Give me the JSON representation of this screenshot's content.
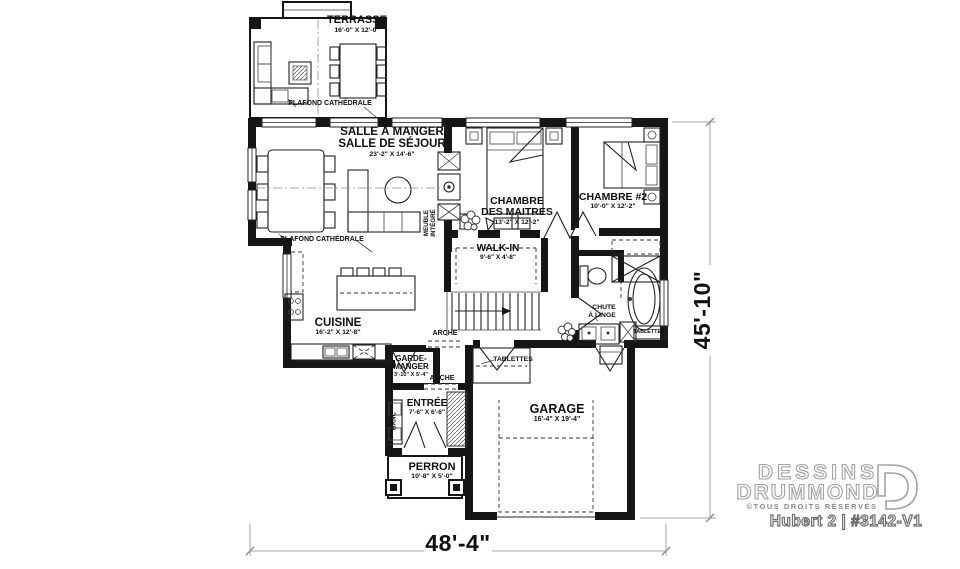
{
  "plan": {
    "rooms": {
      "terrasse": {
        "name": "TERRASSE",
        "dims": "16'-0\" X 12'-0\""
      },
      "salle_a_manger": {
        "line1": "SALLE À MANGER",
        "line2": "SALLE DE SÉJOUR",
        "dims": "23'-2\" X 14'-6\""
      },
      "chambre_maitres": {
        "line1": "CHAMBRE",
        "line2": "DES MAITRES",
        "dims": "13'-2\" X 12'-2\""
      },
      "chambre2": {
        "name": "CHAMBRE #2",
        "dims": "10'-0\" X 12'-2\""
      },
      "walk_in": {
        "name": "WALK-IN",
        "dims": "9'-6\" X 4'-8\""
      },
      "cuisine": {
        "name": "CUISINE",
        "dims": "16'-2\" X 12'-8\""
      },
      "garde_manger": {
        "line1": "GARDE-",
        "line2": "MANGER",
        "dims": "3'-10\" X 5'-4\""
      },
      "entree": {
        "name": "ENTRÉE",
        "dims": "7'-6\" X 6'-6\""
      },
      "perron": {
        "name": "PERRON",
        "dims": "10'-8\" X 5'-0\""
      },
      "garage": {
        "name": "GARAGE",
        "dims": "16'-4\" X 19'-4\""
      }
    },
    "annotations": {
      "plafond_cathedrale_terrasse": "PLAFOND CATHÉDRALE",
      "plafond_cathedrale_sejour": "PLAFOND CATHÉDRALE",
      "meuble_integre_line1": "MEUBLE",
      "meuble_integre_line2": "INTÉGRÉ",
      "arche_hall": "ARCHE",
      "arche_entree": "ARCHE",
      "banc": "BANC",
      "tablettes_garage": "TABLETTES",
      "tablettes_bain": "TABLETTES",
      "chute_line1": "CHUTE",
      "chute_line2": "À LINGE"
    },
    "dimensions": {
      "width": "48'-4\"",
      "height": "45'-10\""
    }
  },
  "branding": {
    "logo_line1": "DESSINS",
    "logo_line2": "DRUMMOND",
    "rights": "©TOUS DROITS RÉSERVÉS",
    "model": "Hubert 2 | #3142-V1"
  }
}
